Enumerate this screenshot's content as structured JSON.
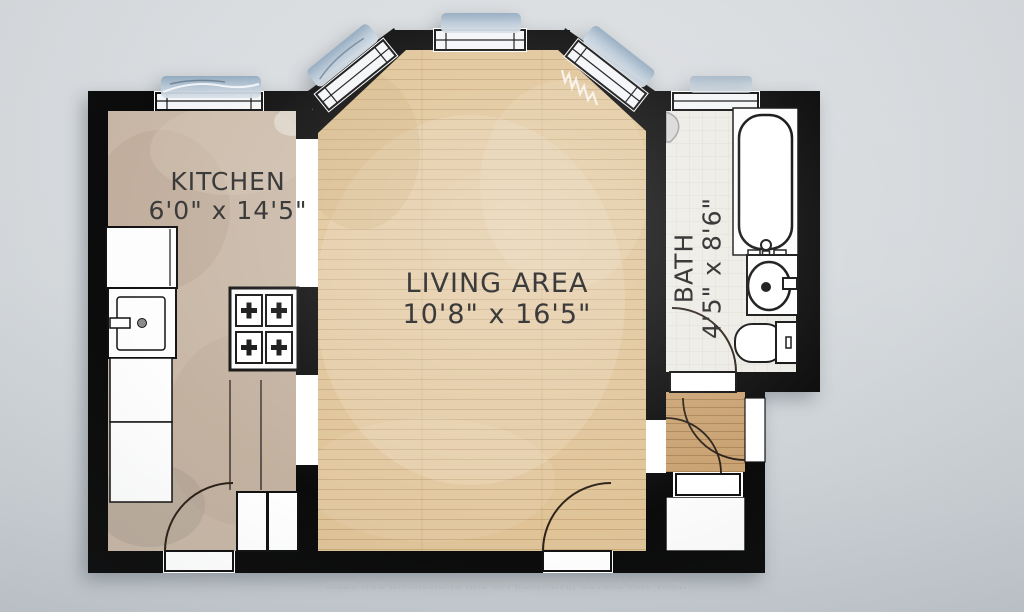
{
  "title": "Studio apartment floor plan",
  "rooms": {
    "kitchen": {
      "name": "KITCHEN",
      "dims": "6'0\" x 14'5\""
    },
    "living_area": {
      "name": "LIVING AREA",
      "dims": "10'8\" x 16'5\""
    },
    "bath": {
      "name": "BATH",
      "dims": "4'5\" x 8'6\""
    }
  },
  "disclaimer": "SIZES AND DIMENSIONS ARE APPROXIMATE, ACTUAL MAY VARY.",
  "fixtures": [
    "kitchen-counter",
    "kitchen-sink",
    "stove-4-burners",
    "double-cabinet",
    "bathtub",
    "bathroom-sink-vanity",
    "toilet",
    "bay-windows",
    "kitchen-window",
    "bath-window",
    "entry-doors",
    "closet"
  ],
  "colors": {
    "wall": "#0b0b0b",
    "living_floor": "#e0c498",
    "kitchen_floor": "#c8b8a8",
    "bath_floor": "#edebe6",
    "vestibule_floor": "#c9a272",
    "window_glass_accent": "#9fb4c8",
    "background_top": "#dadde0",
    "background_bottom": "#c3c9ce",
    "label_text": "#3b3b3b",
    "disclaimer_text": "#b4b8bb"
  }
}
